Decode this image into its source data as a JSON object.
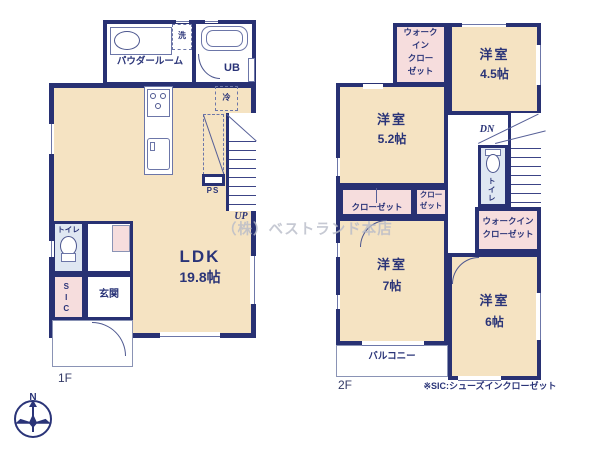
{
  "watermark": "（株）ベストランド本店",
  "note": "※SIC:シューズインクローゼット",
  "compass": {
    "north": "N"
  },
  "floor1": {
    "label": "1F",
    "powder_room": "パウダールーム",
    "washer": "洗",
    "bath": "UB",
    "fridge": "冷",
    "pipe_space": "PS",
    "stairs_up": "UP",
    "ldk": {
      "name": "LDK",
      "size": "19.8帖"
    },
    "toilet": "トイレ",
    "shoe_closet": "SIC",
    "entrance": "玄関"
  },
  "floor2": {
    "label": "2F",
    "wic_top": [
      "ウォーク",
      "イン",
      "クロー",
      "ゼット"
    ],
    "room_45": {
      "name": "洋室",
      "size": "4.5帖"
    },
    "room_52": {
      "name": "洋室",
      "size": "5.2帖"
    },
    "closet_wide": "クローゼット",
    "closet_small": [
      "クロー",
      "ゼット"
    ],
    "stairs_down": "DN",
    "toilet": "トイレ",
    "wic_right": [
      "ウォークイン",
      "クローゼット"
    ],
    "room_7": {
      "name": "洋室",
      "size": "7帖"
    },
    "room_6": {
      "name": "洋室",
      "size": "6帖"
    },
    "balcony": "バルコニー"
  }
}
